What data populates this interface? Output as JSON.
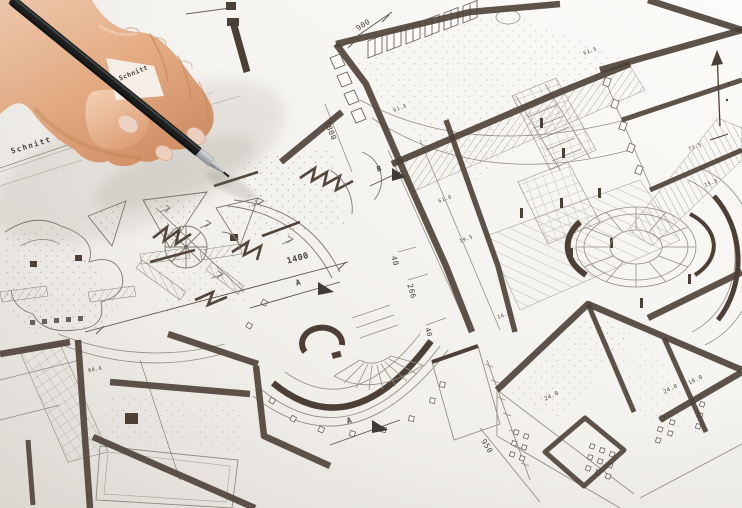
{
  "scene": {
    "drawing_language": "German",
    "section_label": "Schnitt  A - A",
    "section_label_partial": "Schnitt"
  },
  "colors": {
    "paper": "#f4f1ec",
    "wall_ink": "#4c4036",
    "line_ink": "#8f8a81",
    "hatch_ink": "#a8a299",
    "pencil_body": "#1b1e1d",
    "pencil_metal": "#c3c7ca",
    "skin_mid": "#e6ad85",
    "watch_metal": "#c9ccd0"
  },
  "annotations": [
    {
      "id": "schnitt-a-a",
      "text": "Schnitt  A - A",
      "x": 10,
      "y": 148,
      "rot": -17,
      "size": 7.5,
      "weight": 700,
      "ls": 1.5
    },
    {
      "id": "schnitt-partial",
      "text": "Schnitt",
      "x": 118,
      "y": 76,
      "rot": -22,
      "size": 6.5,
      "weight": 700,
      "layer": "above"
    },
    {
      "id": "dim-900",
      "text": "900",
      "x": 355,
      "y": 26,
      "rot": -33,
      "size": 7.5
    },
    {
      "id": "dim-1800",
      "text": "1800",
      "x": 330,
      "y": 120,
      "rot": 68,
      "size": 7.5
    },
    {
      "id": "area-61-5-top",
      "text": "61.5",
      "x": 583,
      "y": 52,
      "rot": -20,
      "size": 5
    },
    {
      "id": "area-72-5",
      "text": "72.5",
      "x": 688,
      "y": 148,
      "rot": -20,
      "size": 5
    },
    {
      "id": "area-15-5",
      "text": "15.5",
      "x": 704,
      "y": 184,
      "rot": -20,
      "size": 5
    },
    {
      "id": "area-61-5",
      "text": "61.5",
      "x": 393,
      "y": 109,
      "rot": -20,
      "size": 5
    },
    {
      "id": "area-61-0",
      "text": "61.0",
      "x": 438,
      "y": 200,
      "rot": -20,
      "size": 5
    },
    {
      "id": "area-19-5",
      "text": "19.5",
      "x": 459,
      "y": 240,
      "rot": -20,
      "size": 5
    },
    {
      "id": "area-16-8",
      "text": "16.8",
      "x": 497,
      "y": 316,
      "rot": -20,
      "size": 5
    },
    {
      "id": "dim-1400",
      "text": "1400",
      "x": 286,
      "y": 258,
      "rot": -16,
      "size": 8.5,
      "weight": 600
    },
    {
      "id": "marker-a-north",
      "text": "A",
      "x": 295,
      "y": 280,
      "rot": -15,
      "size": 8,
      "weight": 700
    },
    {
      "id": "dim-40",
      "text": "40",
      "x": 397,
      "y": 255,
      "rot": 74,
      "size": 7.5
    },
    {
      "id": "dim-266",
      "text": "266",
      "x": 413,
      "y": 283,
      "rot": 74,
      "size": 7.5
    },
    {
      "id": "dim-40-b",
      "text": "40",
      "x": 430,
      "y": 327,
      "rot": 74,
      "size": 7
    },
    {
      "id": "marker-b",
      "text": "B",
      "x": 376,
      "y": 166,
      "rot": -15,
      "size": 7.5,
      "weight": 700
    },
    {
      "id": "marker-a-south",
      "text": "A",
      "x": 346,
      "y": 418,
      "rot": -15,
      "size": 8,
      "weight": 700
    },
    {
      "id": "area-60-6",
      "text": "60.6",
      "x": 88,
      "y": 369,
      "rot": -10,
      "size": 5
    },
    {
      "id": "area-24-0-left",
      "text": "24.0",
      "x": 544,
      "y": 398,
      "rot": -26,
      "size": 5.5
    },
    {
      "id": "area-24-0-right",
      "text": "24.0",
      "x": 663,
      "y": 391,
      "rot": -26,
      "size": 5.5
    },
    {
      "id": "area-18-0",
      "text": "18.0",
      "x": 688,
      "y": 382,
      "rot": -26,
      "size": 5.5
    },
    {
      "id": "dim-950",
      "text": "950",
      "x": 486,
      "y": 438,
      "rot": 58,
      "size": 7.5
    }
  ]
}
